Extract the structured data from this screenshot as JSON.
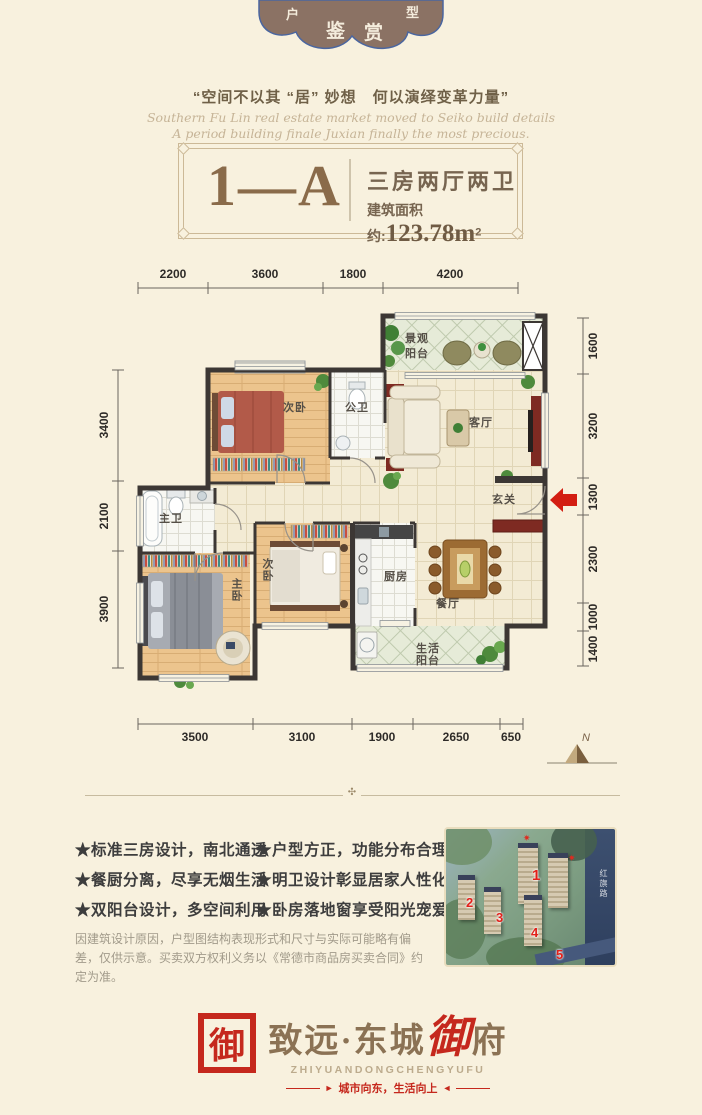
{
  "colors": {
    "accent_red": "#c5281d",
    "brand_brown": "#8b7254",
    "badge_brown": "#8b7264",
    "wall_dark": "#3c3734",
    "wood_floor": "#ecc48d",
    "page_bg": "#f8f1de"
  },
  "badge": {
    "chars": [
      "户",
      "鉴",
      "赏",
      "型"
    ]
  },
  "slogan": "“空间不以其 “居” 妙想　何以演绎变革力量”",
  "english_script": {
    "line1": "Southern Fu Lin real estate market moved to Seiko build details",
    "line2": "A period building finale Juxian  finally the most precious."
  },
  "title_box": {
    "unit": "1—A",
    "type": "三房两厅两卫",
    "area_label": "建筑面积约:",
    "area_value": "123.78m",
    "area_sup": "2"
  },
  "plan": {
    "dims_top": [
      "2200",
      "3600",
      "1800",
      "4200"
    ],
    "dims_bottom": [
      "3500",
      "3100",
      "1900",
      "2650",
      "650"
    ],
    "dims_left": [
      "3400",
      "2100",
      "3900"
    ],
    "dims_right": [
      "1600",
      "3200",
      "1300",
      "2300",
      "1000",
      "1400"
    ],
    "rooms": {
      "bedroom_top": "次卧",
      "public_bath": "公卫",
      "living": "客厅",
      "view_balcony": [
        "景观",
        "阳台"
      ],
      "entry": "玄关",
      "master_bath": "主卫",
      "master_bedroom": "主卧",
      "bedroom_mid": "次卧",
      "kitchen": "厨房",
      "dining": "餐厅",
      "life_balcony": [
        "生活",
        "阳台"
      ]
    },
    "north": "N"
  },
  "features": {
    "left": [
      "★标准三房设计，南北通透",
      "★餐厨分离，尽享无烟生活",
      "★双阳台设计，多空间利用"
    ],
    "right": [
      "★户型方正，功能分布合理",
      "★明卫设计彰显居家人性化",
      "★卧房落地窗享受阳光宠爱"
    ]
  },
  "disclaimer": "因建筑设计原因，户型图结构表现形式和尺寸与实际可能略有偏差，仅供示意。买卖双方权利义务以《常德市商品房买卖合同》约定为准。",
  "rendering": {
    "numbers": [
      "1",
      "2",
      "3",
      "4",
      "5"
    ],
    "star_icon": "✷",
    "road_label": "红旗路"
  },
  "divider": {
    "ornament": "✣"
  },
  "logo": {
    "seal": "御",
    "brand_prefix": "致远·东城",
    "brand_accent": "御",
    "brand_suffix": "府",
    "latin": "ZHIYUANDONGCHENGYUFU",
    "tagline": "城市向东，生活向上",
    "arrow_left": "►",
    "arrow_right": "◄"
  }
}
